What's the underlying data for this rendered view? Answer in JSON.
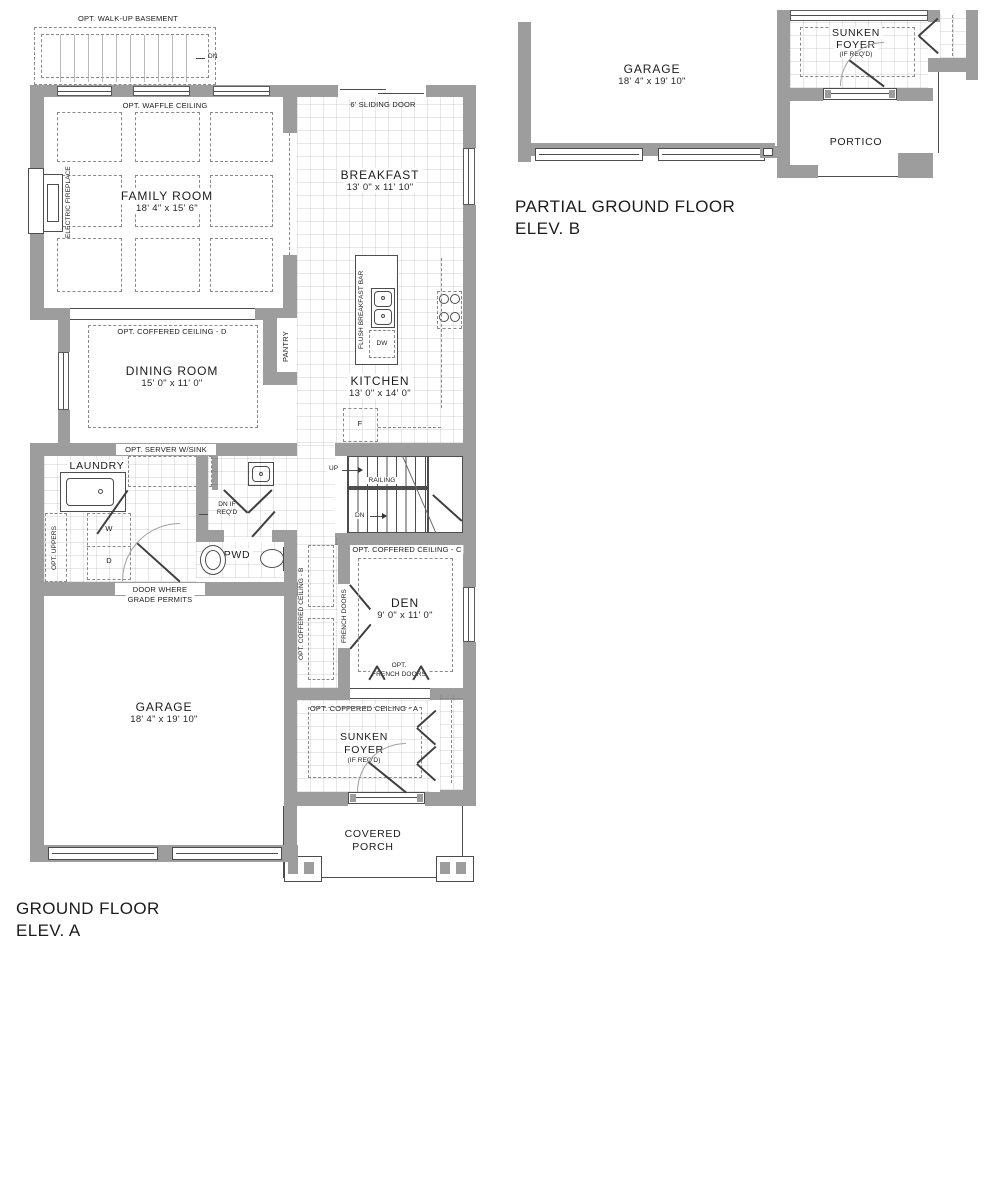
{
  "colors": {
    "wall": "#9d9d9d",
    "outline": "#4d4d4d",
    "text": "#1c1c1c",
    "dash": "#8a8a8a",
    "tile_line": "#e3e3e3"
  },
  "plan_a": {
    "title_line1": "GROUND FLOOR",
    "title_line2": "ELEV. A",
    "rooms": {
      "family_room": {
        "name": "FAMILY ROOM",
        "dims": "18' 4\" x 15' 6\""
      },
      "breakfast": {
        "name": "BREAKFAST",
        "dims": "13' 0\" x 11' 10\""
      },
      "kitchen": {
        "name": "KITCHEN",
        "dims": "13' 0\" x 14' 0\""
      },
      "dining_room": {
        "name": "DINING ROOM",
        "dims": "15' 0\" x 11' 0\""
      },
      "den": {
        "name": "DEN",
        "dims": "9' 0\" x 11' 0\""
      },
      "garage": {
        "name": "GARAGE",
        "dims": "18' 4\" x 19' 10\""
      },
      "laundry": {
        "name": "LAUNDRY"
      },
      "powder_room": {
        "name": "PWD"
      },
      "sunken_foyer": {
        "line1": "SUNKEN",
        "line2": "FOYER",
        "note": "(IF REQ'D)"
      },
      "covered_porch": {
        "line1": "COVERED",
        "line2": "PORCH"
      }
    },
    "notes": {
      "walkup_basement": "OPT. WALK-UP BASEMENT",
      "walkup_dn": "DN",
      "waffle_ceiling": "OPT. WAFFLE CEILING",
      "electric_fireplace": "ELECTRIC FIREPLACE",
      "sliding_door": "6' SLIDING DOOR",
      "flush_breakfast_bar": "FLUSH BREAKFAST BAR",
      "dishwasher": "DW",
      "fridge": "F",
      "pantry": "PANTRY",
      "coffered_d": "OPT. COFFERED CEILING - D",
      "server_sink": "OPT. SERVER W/SINK",
      "opt_uppers": "OPT. UPPERS",
      "washer": "W",
      "dryer": "D",
      "up": "UP",
      "railing": "RAILING",
      "dn": "DN",
      "dn_if_line1": "DN IF",
      "dn_if_line2": "REQ'D",
      "door_grade_line1": "DOOR WHERE",
      "door_grade_line2": "GRADE PERMITS",
      "coffered_b": "OPT. COFFERED CEILING - B",
      "french_doors": "FRENCH DOORS",
      "coffered_c": "OPT. COFFERED CEILING - C",
      "opt_french_line1": "OPT.",
      "opt_french_line2": "FRENCH DOORS",
      "coffered_a": "OPT. COFFERED CEILING - A"
    }
  },
  "plan_b": {
    "title_line1": "PARTIAL GROUND FLOOR",
    "title_line2": "ELEV. B",
    "rooms": {
      "garage": {
        "name": "GARAGE",
        "dims": "18' 4\" x 19' 10\""
      },
      "sunken_foyer": {
        "line1": "SUNKEN",
        "line2": "FOYER",
        "note": "(IF REQ'D)"
      },
      "portico": {
        "name": "PORTICO"
      }
    }
  }
}
